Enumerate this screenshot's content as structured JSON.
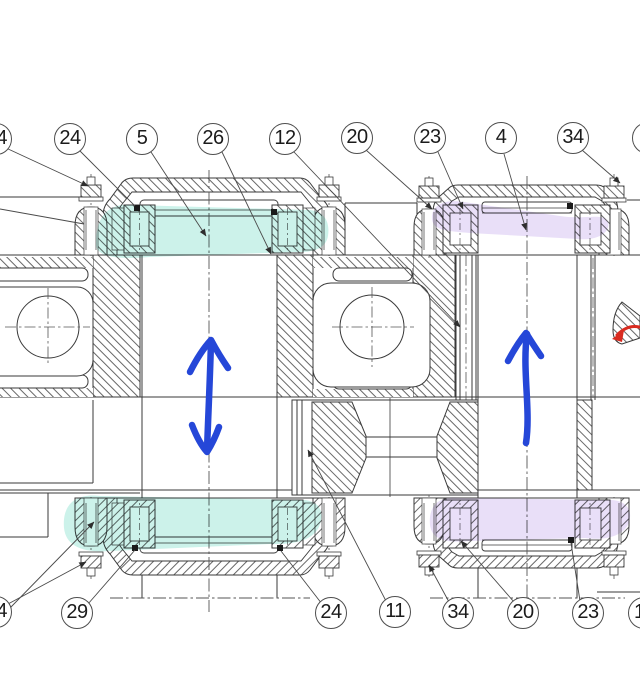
{
  "balloons": {
    "top": [
      {
        "label": "4"
      },
      {
        "label": "24"
      },
      {
        "label": "5"
      },
      {
        "label": "26"
      },
      {
        "label": "12"
      },
      {
        "label": "20"
      },
      {
        "label": "23"
      },
      {
        "label": "4"
      },
      {
        "label": "34"
      },
      {
        "label": ""
      }
    ],
    "bottom": [
      {
        "label": "4"
      },
      {
        "label": "29"
      },
      {
        "label": "24"
      },
      {
        "label": "11"
      },
      {
        "label": "34"
      },
      {
        "label": "20"
      },
      {
        "label": "23"
      },
      {
        "label": "1"
      }
    ]
  },
  "colors": {
    "line": "#3a3a3a",
    "highlight_teal": "#8fe3d1",
    "highlight_purple": "#cfb9f0",
    "arrow_blue": "#2547d8",
    "arrow_red": "#d92b20"
  },
  "annotations": {
    "left_shaft_arrow": "double-headed-vertical-arrow",
    "right_shaft_arrow": "up-arrow",
    "right_edge_arrow": "left-arrow"
  }
}
